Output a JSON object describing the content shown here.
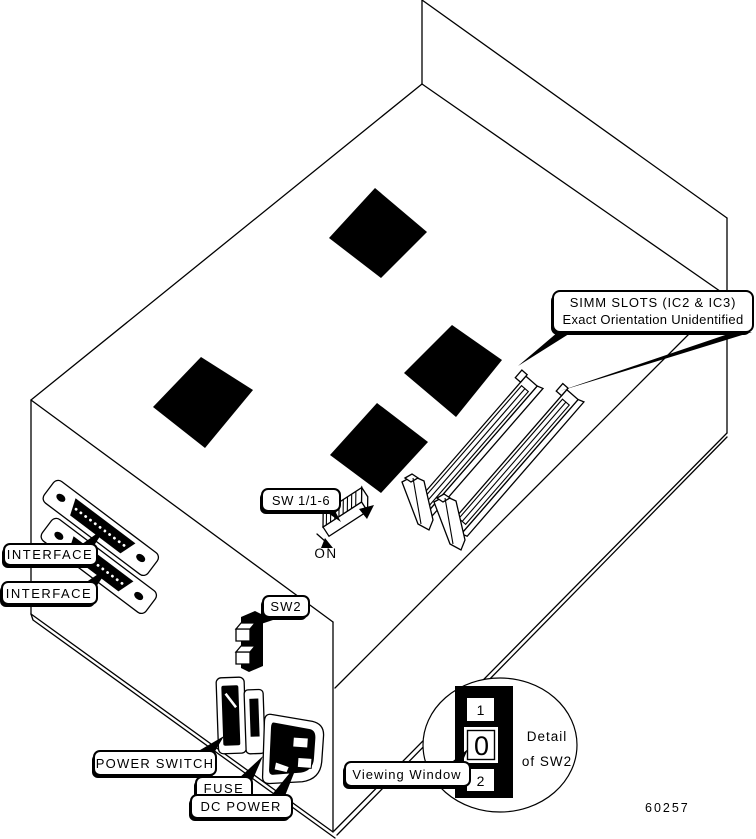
{
  "figure": {
    "number": "60257"
  },
  "colors": {
    "ink": "#000000",
    "paper": "#ffffff"
  },
  "callouts": {
    "simm_slots": {
      "line1": "SIMM SLOTS (IC2 & IC3)",
      "line2": "Exact Orientation Unidentified"
    },
    "interface_top": {
      "label": "INTERFACE"
    },
    "interface_bottom": {
      "label": "INTERFACE"
    },
    "sw1": {
      "label": "SW 1/1-6"
    },
    "sw1_on": {
      "label": "ON"
    },
    "sw2": {
      "label": "SW2"
    },
    "power_switch": {
      "label": "POWER SWITCH"
    },
    "fuse": {
      "label": "FUSE"
    },
    "dc_power": {
      "label": "DC POWER"
    },
    "viewing_window": {
      "label": "Viewing Window"
    }
  },
  "detail_view": {
    "caption_line1": "Detail",
    "caption_line2": "of SW2",
    "positions": [
      "1",
      "0",
      "2"
    ]
  }
}
